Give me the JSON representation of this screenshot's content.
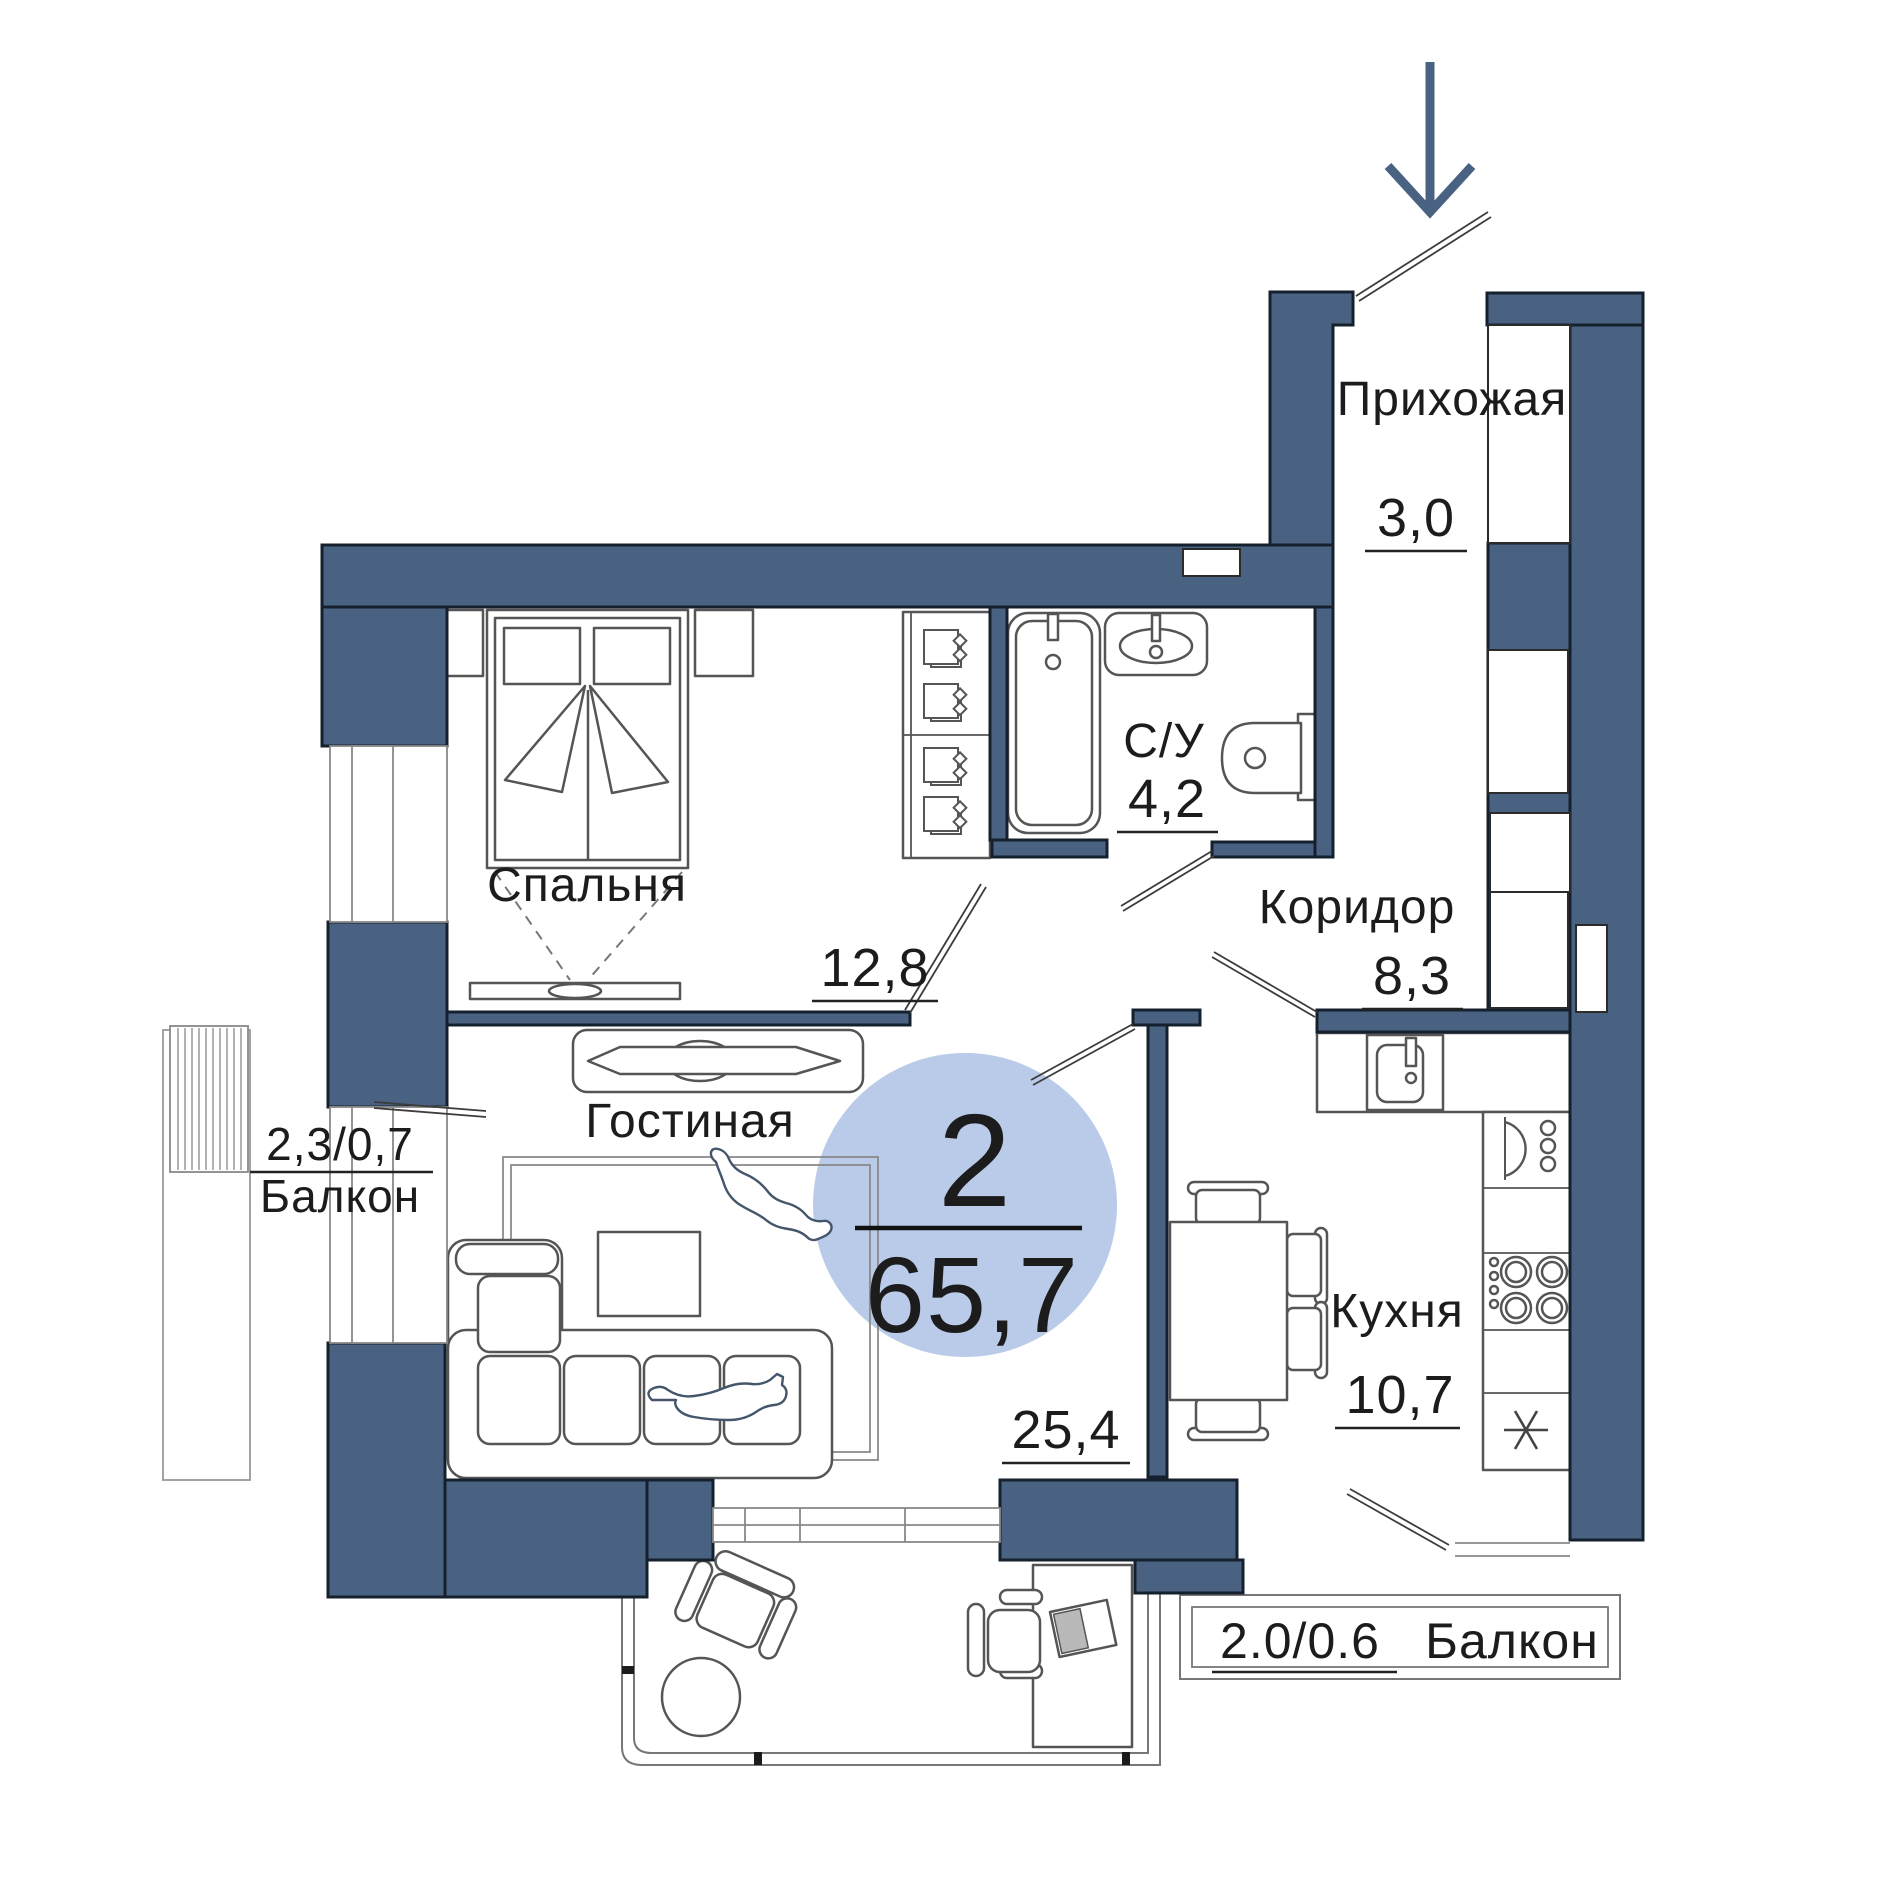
{
  "rooms": {
    "hallway": {
      "name": "Прихожая",
      "area": "3,0"
    },
    "bathroom": {
      "name": "С/У",
      "area": "4,2"
    },
    "corridor": {
      "name": "Коридор",
      "area": "8,3"
    },
    "bedroom": {
      "name": "Спальня",
      "area": "12,8"
    },
    "living": {
      "name": "Гостиная",
      "area": "25,4"
    },
    "kitchen": {
      "name": "Кухня",
      "area": "10,7"
    },
    "balcony_left": {
      "name": "Балкон",
      "area": "2,3/0,7"
    },
    "balcony_bottom": {
      "name": "Балкон",
      "area": "2.0/0.6"
    }
  },
  "badge": {
    "rooms": "2",
    "area": "65,7"
  },
  "colors": {
    "wall": "#4A6282",
    "badge": "#B9CBE8",
    "text": "#1C1C1C",
    "furniture": "#555555",
    "thin": "#8A8A8A"
  },
  "icons": {
    "entrance": "entrance-arrow-down",
    "fridge": "snowflake-asterisk",
    "wardrobe": "clothes-hangers",
    "laundry": "washing-machine",
    "pets": "two-cats"
  }
}
